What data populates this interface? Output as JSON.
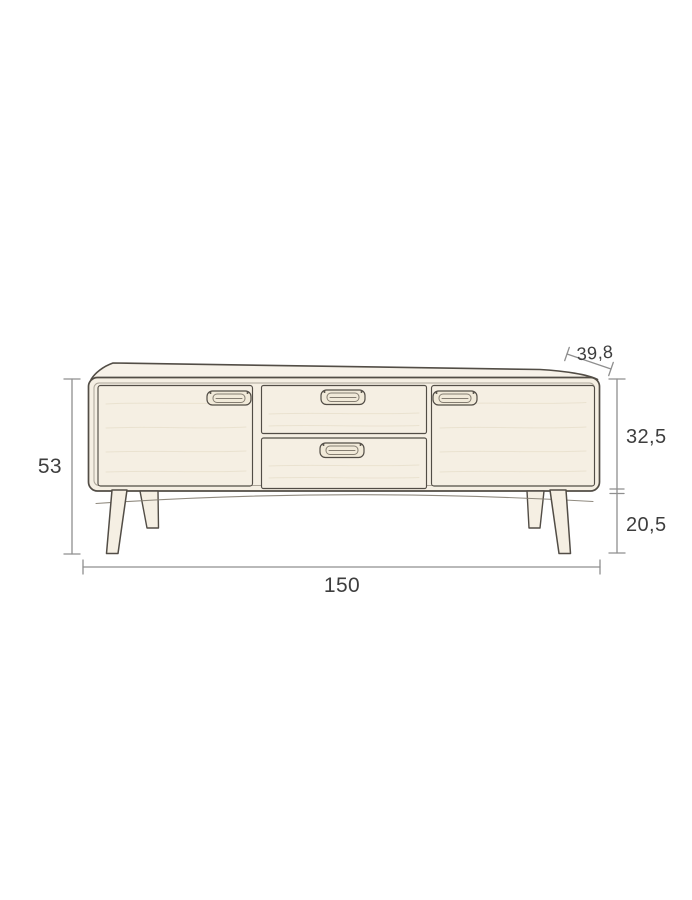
{
  "diagram": {
    "title": "sideboard-dimension-drawing",
    "dimensions": {
      "height": "53",
      "depth": "39,8",
      "body_height": "32,5",
      "leg_height": "20,5",
      "width": "150"
    }
  },
  "colors": {
    "background": "#ffffff",
    "line": "#524d46",
    "line_soft": "#847d71",
    "fill": "#f5efe3",
    "fill_top": "#f7f2e9",
    "fill_handle": "#f1ead9",
    "grain": "#e6ddca",
    "dim": "#8f8f8f",
    "text": "#3e3e3e"
  }
}
